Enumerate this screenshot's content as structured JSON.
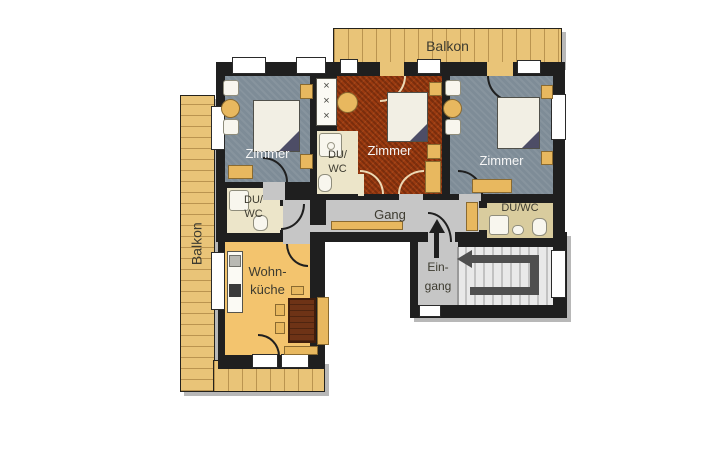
{
  "title": "Apartment floor plan",
  "floorplan": {
    "labels": {
      "balkon_top": "Balkon",
      "balkon_left": "Balkon",
      "zimmer_left": "Zimmer",
      "zimmer_middle": "Zimmer",
      "zimmer_right": "Zimmer",
      "du_wc_middle_line1": "DU/",
      "du_wc_middle_line2": "WC",
      "du_wc_left_line1": "DU/",
      "du_wc_left_line2": "WC",
      "du_wc_right": "DU/WC",
      "gang": "Gang",
      "eingang_line1": "Ein-",
      "eingang_line2": "gang",
      "wohnkueche_line1": "Wohn-",
      "wohnkueche_line2": "küche"
    },
    "symbols": {
      "wardrobe_marks": "×\n×\n×"
    },
    "colors": {
      "wall": "#1f1f1f",
      "wood": "#e9c478",
      "floor-blue": "#7e8c97",
      "floor-red": "#9a3a10",
      "floor-beige": "#ece5c9",
      "floor-tan-wc": "#d9cc9e",
      "floor-gray": "#c6c6c6",
      "floor-stairs": "#e9e9e9",
      "floor-kitchen": "#f3c46e",
      "furniture-tan": "#e8b85f",
      "bed-white": "#f2efe4",
      "blanket-dark": "#4d4d66",
      "table-brown": "#6e3316",
      "arrow-dark": "#4f4f4f",
      "label-dark": "#3d3b30",
      "label-light": "#f5f5f5"
    }
  }
}
